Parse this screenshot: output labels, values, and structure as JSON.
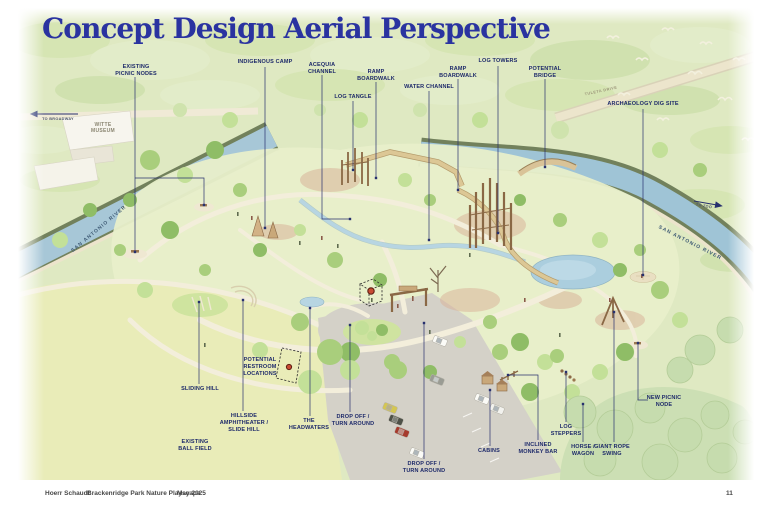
{
  "title": "Concept Design Aerial Perspective",
  "footer": {
    "firm": "Hoerr Schaudt",
    "project": "Brackenridge Park Nature Playscape",
    "date": "May 2025",
    "page": "11"
  },
  "map_labels": {
    "witte_museum": "WITTE\nMUSEUM",
    "san_antonio_river_left": "SAN ANTONIO RIVER",
    "san_antonio_river_right": "SAN ANTONIO RIVER",
    "tuleta_drive": "TULETA DRIVE",
    "to_broadway": "TO BROADWAY",
    "to_zoo": "TO ZOO"
  },
  "callouts": [
    {
      "id": "existing-picnic-nodes",
      "label": "EXISTING\nPICNIC NODES"
    },
    {
      "id": "indigenous-camp",
      "label": "INDIGENOUS CAMP"
    },
    {
      "id": "acequia-channel",
      "label": "ACEQUIA\nCHANNEL"
    },
    {
      "id": "log-tangle",
      "label": "LOG TANGLE"
    },
    {
      "id": "ramp-boardwalk-west",
      "label": "RAMP\nBOARDWALK"
    },
    {
      "id": "water-channel",
      "label": "WATER CHANNEL"
    },
    {
      "id": "ramp-boardwalk-east",
      "label": "RAMP\nBOARDWALK"
    },
    {
      "id": "log-towers",
      "label": "LOG TOWERS"
    },
    {
      "id": "potential-bridge",
      "label": "POTENTIAL\nBRIDGE"
    },
    {
      "id": "archaeology-dig-site",
      "label": "ARCHAEOLOGY DIG SITE"
    },
    {
      "id": "sliding-hill",
      "label": "SLIDING HILL"
    },
    {
      "id": "potential-restroom-locations",
      "label": "POTENTIAL\nRESTROOM\nLOCATIONS"
    },
    {
      "id": "hillside-amphitheater",
      "label": "HILLSIDE\nAMPHITHEATER /\nSLIDE HILL"
    },
    {
      "id": "the-headwaters",
      "label": "THE\nHEADWATERS"
    },
    {
      "id": "drop-off-turn-around-west",
      "label": "DROP OFF /\nTURN AROUND"
    },
    {
      "id": "existing-ball-field",
      "label": "EXISTING\nBALL FIELD"
    },
    {
      "id": "drop-off-turn-around-south",
      "label": "DROP OFF /\nTURN AROUND"
    },
    {
      "id": "cabins",
      "label": "CABINS"
    },
    {
      "id": "inclined-monkey-bar",
      "label": "INCLINED\nMONKEY BAR"
    },
    {
      "id": "log-steppers",
      "label": "LOG\nSTEPPERS"
    },
    {
      "id": "horse-wagon",
      "label": "HORSE /\nWAGON"
    },
    {
      "id": "giant-rope-swing",
      "label": "GIANT ROPE\nSWING"
    },
    {
      "id": "new-picnic-node",
      "label": "NEW PICNIC\nNODE"
    }
  ],
  "colors": {
    "title_blue": "#2a33a0",
    "annotation_navy": "#27306e",
    "river_blue": "#a7c7d7",
    "canopy_green": "#dfe9c2",
    "meadow_green": "#e8efca",
    "ball_field_green": "#e9ecb8",
    "path_cream": "#f3eedb",
    "parking_gray": "#d4d1c8",
    "wood_brown": "#9b7850",
    "restroom_marker_red": "#b33a25"
  }
}
